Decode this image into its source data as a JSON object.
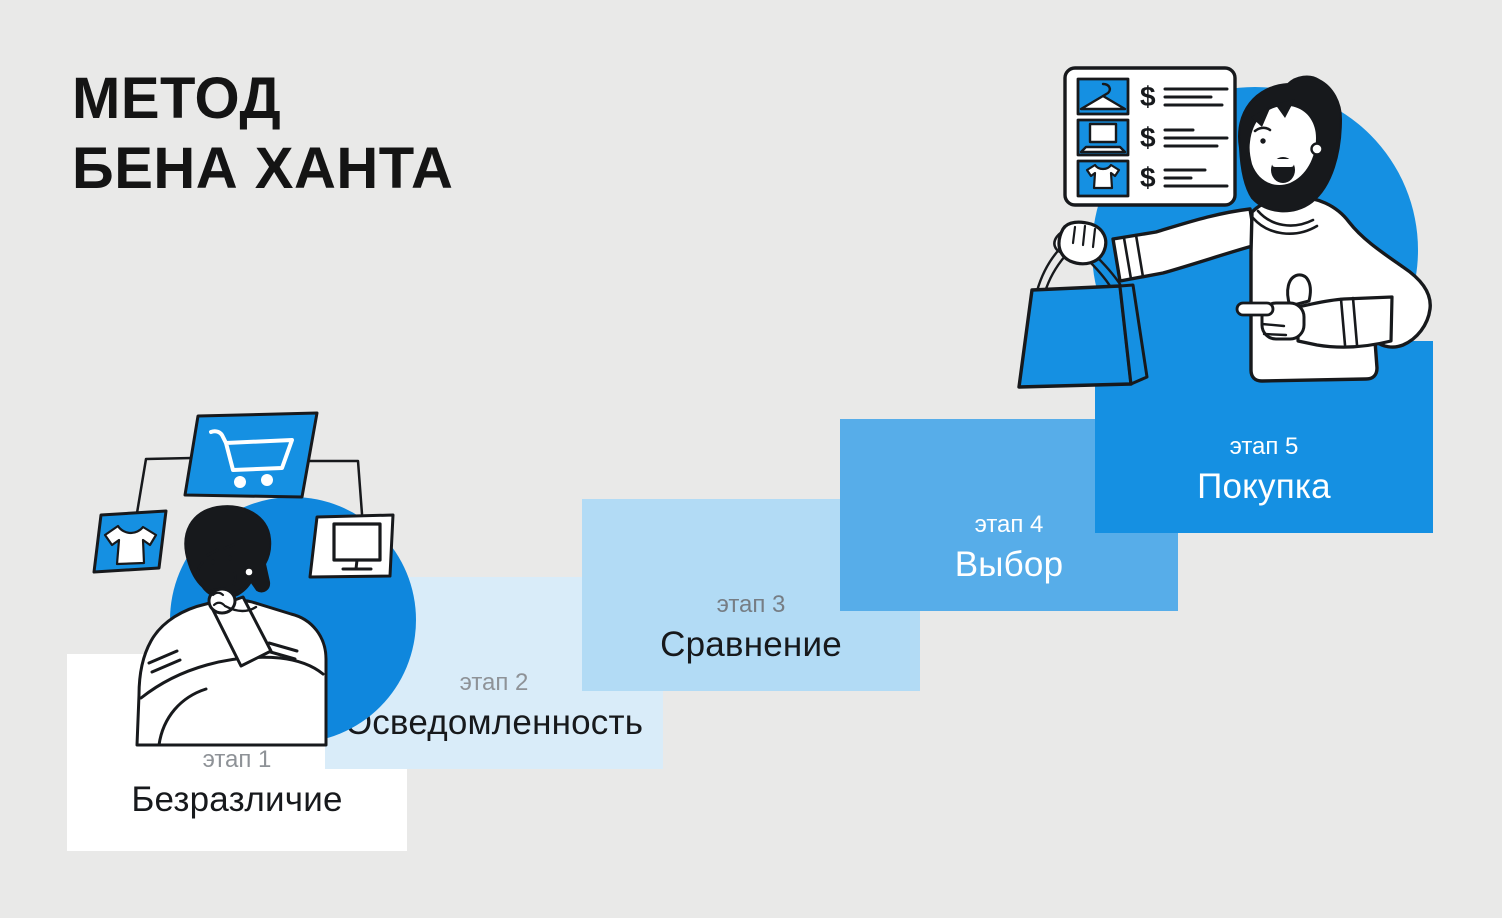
{
  "page": {
    "background": "#e9e9e8"
  },
  "title": {
    "line1": "МЕТОД",
    "line2": "БЕНА ХАНТА",
    "color": "#141414"
  },
  "steps": [
    {
      "label": "этап 1",
      "title": "Безразличие",
      "bg": "#ffffff",
      "label_color": "#8e9297",
      "title_color": "#17191c"
    },
    {
      "label": "этап 2",
      "title": "Осведомленность",
      "bg": "#d9ecf9",
      "label_color": "#8e9297",
      "title_color": "#17191c"
    },
    {
      "label": "этап 3",
      "title": "Сравнение",
      "bg": "#b2dbf5",
      "label_color": "#767d84",
      "title_color": "#17191c"
    },
    {
      "label": "этап 4",
      "title": "Выбор",
      "bg": "#57ade9",
      "label_color": "#ffffff",
      "title_color": "#ffffff"
    },
    {
      "label": "этап 5",
      "title": "Покупка",
      "bg": "#1590e2",
      "label_color": "#ffffff",
      "title_color": "#ffffff"
    }
  ],
  "colors": {
    "accent": "#1590e2",
    "accent-deep": "#0f87dd",
    "ink": "#17191c",
    "paper": "#ffffff",
    "page-bg": "#e9e9e8"
  },
  "illustrations": {
    "left": {
      "description": "Задумчивый человек со скрещенными руками, вокруг — корзина покупок, футболка и монитор",
      "icons": [
        "shopping-cart-icon",
        "tshirt-icon",
        "monitor-icon"
      ]
    },
    "right": {
      "description": "Радостный человек с пакетом покупок указывает на него, рядом карточка прайс-листа",
      "icons": [
        "clothes-hanger-icon",
        "laptop-icon",
        "tshirt-icon",
        "shopping-bag-icon"
      ],
      "price_rows": [
        {
          "icon": "clothes-hanger-icon",
          "currency": "$"
        },
        {
          "icon": "laptop-icon",
          "currency": "$"
        },
        {
          "icon": "tshirt-icon",
          "currency": "$"
        }
      ]
    }
  }
}
